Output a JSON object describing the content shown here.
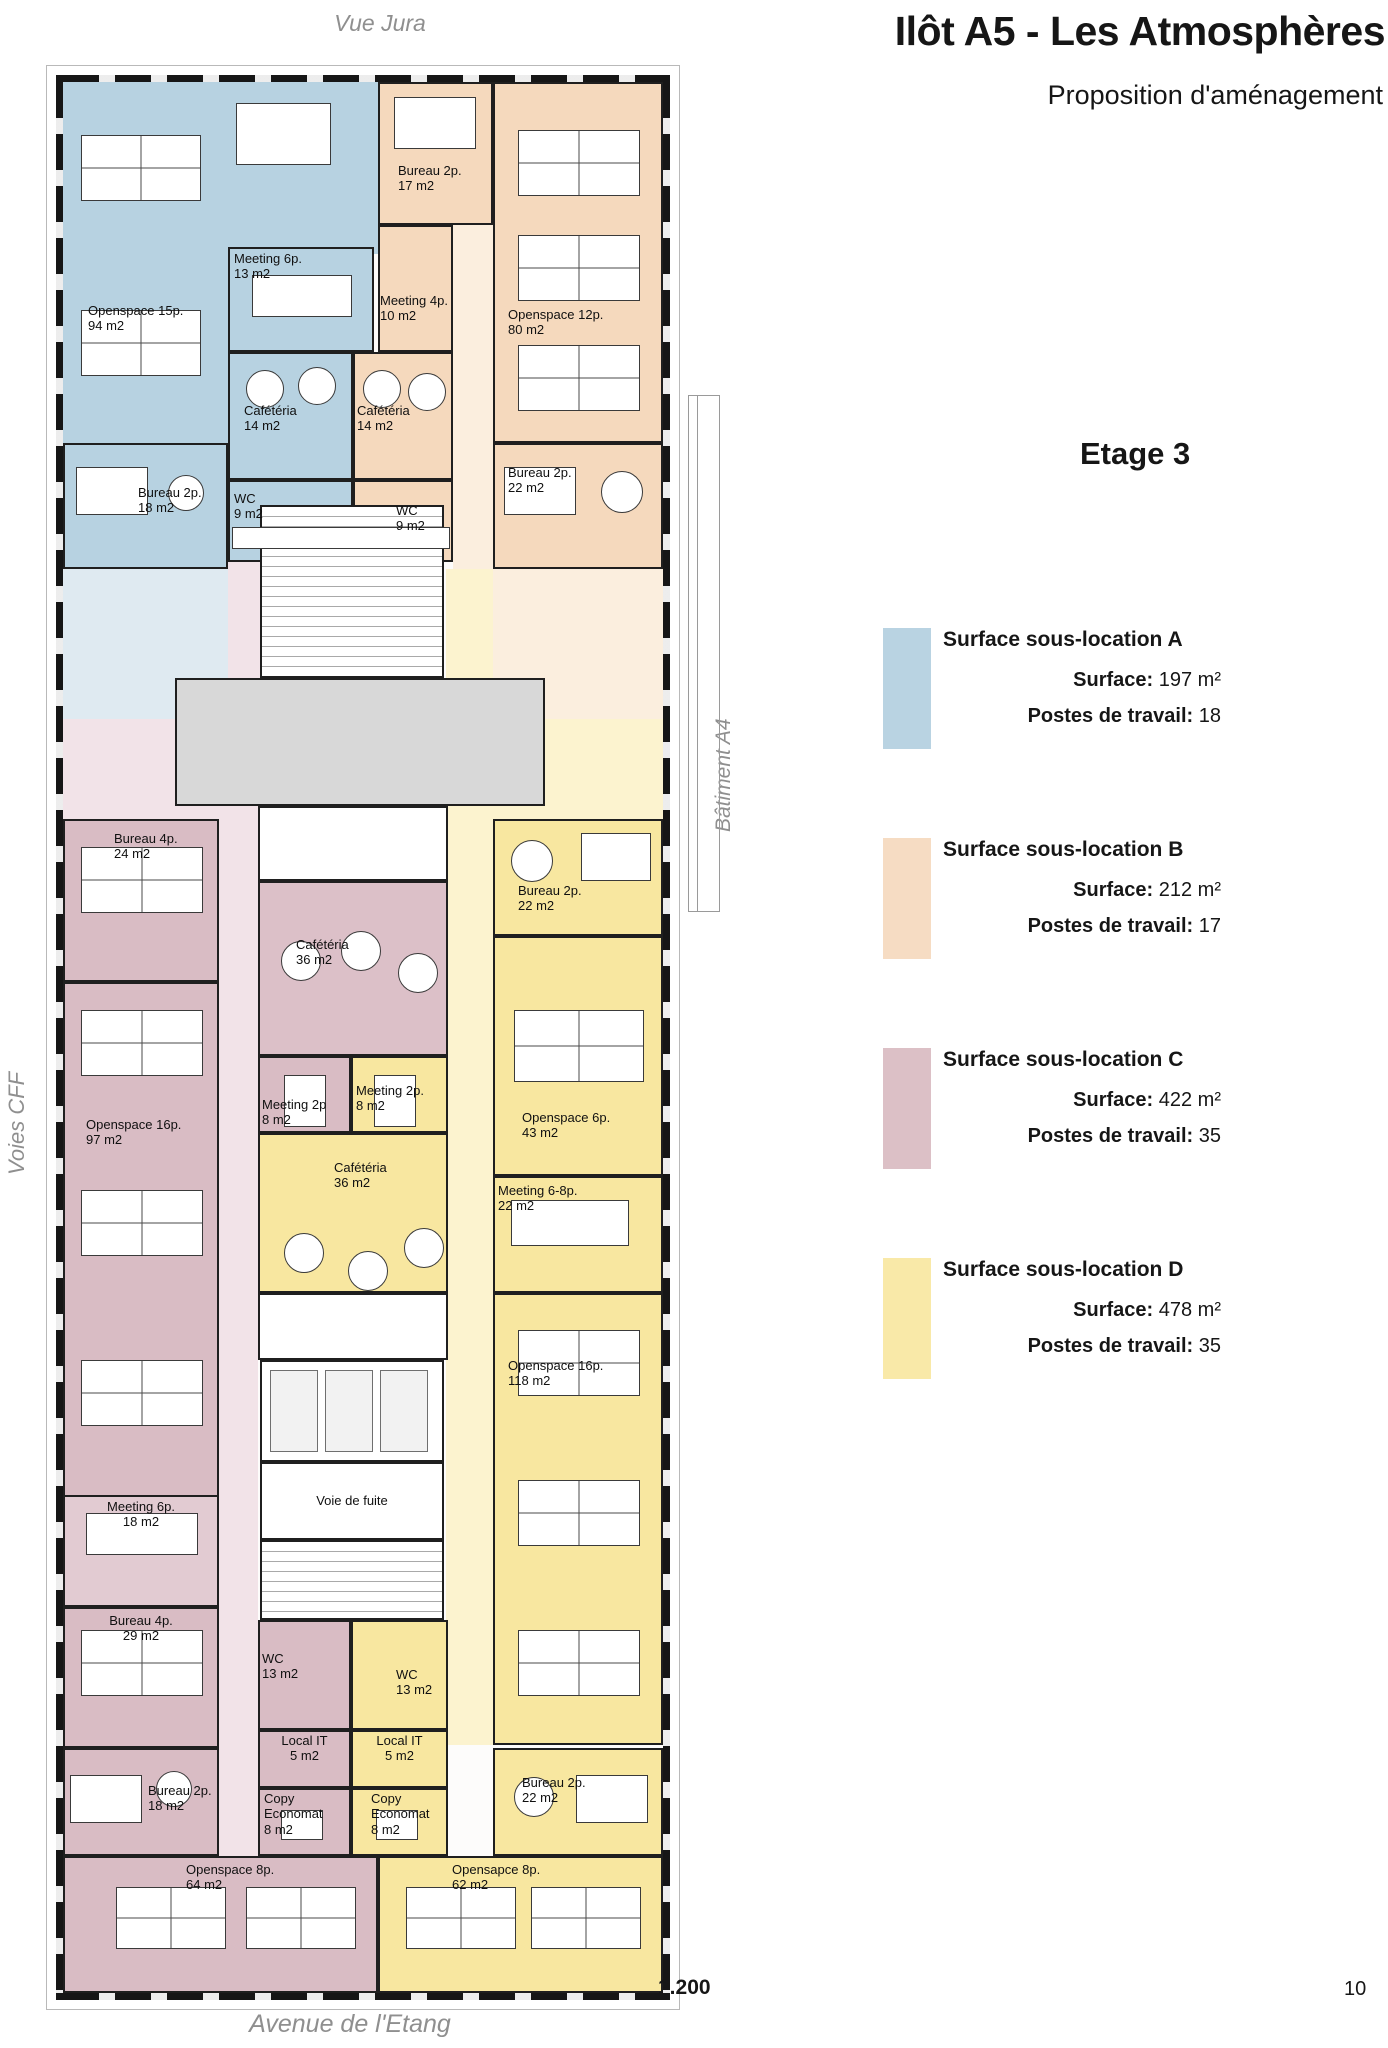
{
  "page": {
    "number": "10",
    "scale_label": "1.200"
  },
  "header": {
    "title": "Ilôt A5 - Les Atmosphères",
    "subtitle": "Proposition d'aménagement",
    "floor_label": "Etage 3"
  },
  "surroundings": {
    "top": "Vue Jura",
    "left": "Voies CFF",
    "right": "Bâtiment A4",
    "bottom": "Avenue de l'Etang"
  },
  "legend": {
    "items": [
      {
        "id": "A",
        "color": "#b9d3e2",
        "title": "Surface sous-location A",
        "surface_label": "Surface:",
        "surface_value": "197 m²",
        "postes_label": "Postes de travail:",
        "postes_value": "18"
      },
      {
        "id": "B",
        "color": "#f6dcc3",
        "title": "Surface sous-location B",
        "surface_label": "Surface:",
        "surface_value": "212 m²",
        "postes_label": "Postes de travail:",
        "postes_value": "17"
      },
      {
        "id": "C",
        "color": "#dcc0c6",
        "title": "Surface sous-location C",
        "surface_label": "Surface:",
        "surface_value": "422 m²",
        "postes_label": "Postes de travail:",
        "postes_value": "35"
      },
      {
        "id": "D",
        "color": "#f9e9a8",
        "title": "Surface sous-location D",
        "surface_label": "Surface:",
        "surface_value": "478 m²",
        "postes_label": "Postes de travail:",
        "postes_value": "35"
      }
    ]
  },
  "floorplan": {
    "zone_colors": {
      "A": "#b7d2e1",
      "B": "#f5d9bd",
      "C": "#d9bcc4",
      "D": "#f8e7a0",
      "core": "#d8d8d8"
    },
    "rooms": [
      {
        "id": "zone-a-band",
        "x": 7,
        "y": 7,
        "w": 315,
        "h": 172,
        "fill": "#b7d2e1",
        "wall": false
      },
      {
        "id": "openspace-15p",
        "x": 7,
        "y": 179,
        "w": 165,
        "h": 189,
        "fill": "#b7d2e1",
        "wall": false,
        "label": "Openspace 15p.\n94 m2",
        "lx": 32,
        "ly": 228
      },
      {
        "id": "corridor-b",
        "x": 397,
        "y": 7,
        "w": 40,
        "h": 487,
        "fill": "#fbeede",
        "wall": false
      },
      {
        "id": "lounge-a",
        "x": 7,
        "y": 494,
        "w": 165,
        "h": 150,
        "fill": "#dfeaf1",
        "wall": false
      },
      {
        "id": "lounge-c-left",
        "x": 7,
        "y": 644,
        "w": 165,
        "h": 100,
        "fill": "#f2e3e8",
        "wall": false
      },
      {
        "id": "lounge-b",
        "x": 437,
        "y": 494,
        "w": 170,
        "h": 150,
        "fill": "#fbeede",
        "wall": false
      },
      {
        "id": "lounge-d",
        "x": 437,
        "y": 644,
        "w": 170,
        "h": 100,
        "fill": "#fcf3cf",
        "wall": false
      },
      {
        "id": "corridor-c-upper",
        "x": 172,
        "y": 487,
        "w": 32,
        "h": 319,
        "fill": "#f2e3e8",
        "wall": false
      },
      {
        "id": "corridor-c-lower",
        "x": 163,
        "y": 744,
        "w": 39,
        "h": 1037,
        "fill": "#f2e3e8",
        "wall": false
      },
      {
        "id": "corridor-d",
        "x": 390,
        "y": 494,
        "w": 47,
        "h": 1176,
        "fill": "#fcf3cf",
        "wall": false
      },
      {
        "id": "meeting-6p-13",
        "x": 172,
        "y": 172,
        "w": 146,
        "h": 105,
        "fill": "#b7d2e1",
        "label": "Meeting 6p.\n13 m2",
        "lx": 178,
        "ly": 176
      },
      {
        "id": "cafeteria-14-a",
        "x": 172,
        "y": 277,
        "w": 125,
        "h": 128,
        "fill": "#b7d2e1",
        "label": "Cafétéria\n14 m2",
        "lx": 188,
        "ly": 328
      },
      {
        "id": "wc-9-a",
        "x": 172,
        "y": 405,
        "w": 125,
        "h": 82,
        "fill": "#b7d2e1",
        "label": "WC\n9 m2",
        "lx": 178,
        "ly": 416
      },
      {
        "id": "bureau-2p-18-a",
        "x": 7,
        "y": 368,
        "w": 165,
        "h": 126,
        "fill": "#b7d2e1",
        "label": "Bureau 2p.\n18 m2",
        "lx": 82,
        "ly": 410
      },
      {
        "id": "bureau-2p-17",
        "x": 322,
        "y": 7,
        "w": 115,
        "h": 143,
        "fill": "#f5d9bd",
        "label": "Bureau 2p.\n17 m2",
        "lx": 342,
        "ly": 88
      },
      {
        "id": "meeting-4p-10",
        "x": 322,
        "y": 150,
        "w": 75,
        "h": 127,
        "fill": "#f5d9bd",
        "label": "Meeting 4p.\n10 m2",
        "lx": 324,
        "ly": 218
      },
      {
        "id": "cafeteria-14-b",
        "x": 297,
        "y": 277,
        "w": 100,
        "h": 128,
        "fill": "#f5d9bd",
        "label": "Cafétéria\n14 m2",
        "lx": 301,
        "ly": 328
      },
      {
        "id": "wc-9-b",
        "x": 297,
        "y": 405,
        "w": 100,
        "h": 82,
        "fill": "#f5d9bd",
        "label": "WC\n9 m2",
        "lx": 340,
        "ly": 428
      },
      {
        "id": "openspace-12p",
        "x": 437,
        "y": 7,
        "w": 170,
        "h": 361,
        "fill": "#f5d9bd",
        "label": "Openspace 12p.\n80 m2",
        "lx": 452,
        "ly": 232
      },
      {
        "id": "bureau-2p-22-b",
        "x": 437,
        "y": 368,
        "w": 170,
        "h": 126,
        "fill": "#f5d9bd",
        "label": "Bureau 2p.\n22 m2",
        "lx": 452,
        "ly": 390
      },
      {
        "id": "stairs-top",
        "x": 204,
        "y": 430,
        "w": 184,
        "h": 173,
        "fill": "#ffffff",
        "hatch": true
      },
      {
        "id": "entry-hall",
        "x": 119,
        "y": 603,
        "w": 370,
        "h": 128,
        "fill": "#d8d8d8"
      },
      {
        "id": "core-landing",
        "x": 202,
        "y": 731,
        "w": 190,
        "h": 75,
        "fill": "#ffffff"
      },
      {
        "id": "bureau-4p-24",
        "x": 7,
        "y": 744,
        "w": 156,
        "h": 163,
        "fill": "#d9bcc4",
        "label": "Bureau 4p.\n24 m2",
        "lx": 58,
        "ly": 756
      },
      {
        "id": "cafeteria-36-c",
        "x": 202,
        "y": 806,
        "w": 190,
        "h": 175,
        "fill": "#dcc0c8",
        "label": "Cafétéria\n36 m2",
        "lx": 240,
        "ly": 862
      },
      {
        "id": "openspace-16p-97",
        "x": 7,
        "y": 907,
        "w": 156,
        "h": 518,
        "fill": "#d9bcc4",
        "label": "Openspace 16p.\n97 m2",
        "lx": 30,
        "ly": 1042
      },
      {
        "id": "meeting-2p-c",
        "x": 202,
        "y": 981,
        "w": 93,
        "h": 77,
        "fill": "#d9bcc4",
        "label": "Meeting 2p\n8 m2",
        "lx": 206,
        "ly": 1022
      },
      {
        "id": "meeting-2p-d",
        "x": 295,
        "y": 981,
        "w": 97,
        "h": 77,
        "fill": "#f8e7a0",
        "label": "Meeting 2p.\n8 m2",
        "lx": 300,
        "ly": 1008
      },
      {
        "id": "cafeteria-36-d",
        "x": 202,
        "y": 1058,
        "w": 190,
        "h": 160,
        "fill": "#f8e7a0",
        "label": "Cafétéria\n36 m2",
        "lx": 278,
        "ly": 1085
      },
      {
        "id": "bureau-2p-22-d-top",
        "x": 437,
        "y": 744,
        "w": 170,
        "h": 117,
        "fill": "#f8e7a0",
        "label": "Bureau 2p.\n22 m2",
        "lx": 462,
        "ly": 808
      },
      {
        "id": "openspace-6p-43",
        "x": 437,
        "y": 861,
        "w": 170,
        "h": 240,
        "fill": "#f8e7a0",
        "label": "Openspace 6p.\n43 m2",
        "lx": 466,
        "ly": 1035
      },
      {
        "id": "meeting-6-8p-22",
        "x": 437,
        "y": 1101,
        "w": 170,
        "h": 117,
        "fill": "#f8e7a0",
        "label": "Meeting 6-8p.\n22 m2",
        "lx": 442,
        "ly": 1108
      },
      {
        "id": "openspace-16p-118",
        "x": 437,
        "y": 1218,
        "w": 170,
        "h": 452,
        "fill": "#f8e7a0",
        "label": "Openspace 16p.\n118 m2",
        "lx": 452,
        "ly": 1283
      },
      {
        "id": "core-mid",
        "x": 202,
        "y": 1218,
        "w": 190,
        "h": 67,
        "fill": "#ffffff"
      },
      {
        "id": "elevators",
        "x": 204,
        "y": 1285,
        "w": 184,
        "h": 102,
        "fill": "#ffffff"
      },
      {
        "id": "voie-de-fuite",
        "x": 204,
        "y": 1387,
        "w": 184,
        "h": 78,
        "fill": "#ffffff",
        "label": "Voie de fuite",
        "la": "c",
        "ly": 1418
      },
      {
        "id": "stairs-bottom",
        "x": 204,
        "y": 1465,
        "w": 184,
        "h": 80,
        "fill": "#ffffff",
        "hatch": true
      },
      {
        "id": "wc-13-c",
        "x": 202,
        "y": 1545,
        "w": 93,
        "h": 110,
        "fill": "#d9bcc4",
        "label": "WC\n13 m2",
        "lx": 206,
        "ly": 1576
      },
      {
        "id": "wc-13-d",
        "x": 295,
        "y": 1545,
        "w": 97,
        "h": 110,
        "fill": "#f8e7a0",
        "label": "WC\n13 m2",
        "lx": 340,
        "ly": 1592
      },
      {
        "id": "local-it-c",
        "x": 202,
        "y": 1655,
        "w": 93,
        "h": 58,
        "fill": "#d9bcc4",
        "label": "Local IT\n5 m2",
        "la": "c",
        "ly": 1658
      },
      {
        "id": "local-it-d",
        "x": 295,
        "y": 1655,
        "w": 97,
        "h": 58,
        "fill": "#f8e7a0",
        "label": "Local IT\n5 m2",
        "la": "c",
        "ly": 1658
      },
      {
        "id": "copy-economat-c",
        "x": 202,
        "y": 1713,
        "w": 93,
        "h": 68,
        "fill": "#d9bcc4",
        "label": "Copy\nEconomat\n8 m2",
        "lx": 208,
        "ly": 1716
      },
      {
        "id": "copy-economat-d",
        "x": 295,
        "y": 1713,
        "w": 97,
        "h": 68,
        "fill": "#f8e7a0",
        "label": "Copy\nEconomat\n8 m2",
        "lx": 315,
        "ly": 1716
      },
      {
        "id": "meeting-6p-18",
        "x": 7,
        "y": 1420,
        "w": 156,
        "h": 112,
        "fill": "#e2cbd2",
        "label": "Meeting 6p.\n18 m2",
        "la": "c",
        "ly": 1424
      },
      {
        "id": "bureau-4p-29",
        "x": 7,
        "y": 1532,
        "w": 156,
        "h": 141,
        "fill": "#d9bcc4",
        "label": "Bureau 4p.\n29 m2",
        "la": "c",
        "ly": 1538
      },
      {
        "id": "bureau-2p-18-c",
        "x": 7,
        "y": 1673,
        "w": 156,
        "h": 108,
        "fill": "#d9bcc4",
        "label": "Bureau 2p.\n18 m2",
        "lx": 92,
        "ly": 1708
      },
      {
        "id": "bureau-2p-22-d",
        "x": 437,
        "y": 1673,
        "w": 170,
        "h": 108,
        "fill": "#f8e7a0",
        "label": "Bureau 2p.\n22 m2",
        "lx": 466,
        "ly": 1700
      },
      {
        "id": "openspace-8p-64",
        "x": 7,
        "y": 1781,
        "w": 315,
        "h": 137,
        "fill": "#d9bcc4",
        "label": "Openspace 8p.\n64 m2",
        "lx": 130,
        "ly": 1787
      },
      {
        "id": "opensapce-8p-62",
        "x": 322,
        "y": 1781,
        "w": 285,
        "h": 137,
        "fill": "#f8e7a0",
        "label": "Opensapce 8p.\n62 m2",
        "lx": 396,
        "ly": 1787
      }
    ],
    "furniture": [
      [
        "c",
        25,
        60,
        120,
        66
      ],
      [
        "c",
        25,
        235,
        120,
        66
      ],
      [
        "r",
        180,
        28,
        95,
        62
      ],
      [
        "r",
        196,
        200,
        100,
        42
      ],
      [
        "o",
        190,
        295,
        38
      ],
      [
        "o",
        242,
        292,
        38
      ],
      [
        "o",
        307,
        295,
        38
      ],
      [
        "o",
        352,
        298,
        38
      ],
      [
        "r",
        338,
        22,
        82,
        52
      ],
      [
        "c",
        462,
        55,
        122,
        66
      ],
      [
        "c",
        462,
        160,
        122,
        66
      ],
      [
        "c",
        462,
        270,
        122,
        66
      ],
      [
        "r",
        448,
        392,
        72,
        48
      ],
      [
        "o",
        545,
        396,
        42
      ],
      [
        "r",
        20,
        392,
        72,
        48
      ],
      [
        "o",
        112,
        400,
        36
      ],
      [
        "r",
        176,
        452,
        218,
        22
      ],
      [
        "c",
        25,
        772,
        122,
        66
      ],
      [
        "o",
        225,
        866,
        40
      ],
      [
        "o",
        285,
        856,
        40
      ],
      [
        "o",
        342,
        878,
        40
      ],
      [
        "c",
        25,
        935,
        122,
        66
      ],
      [
        "c",
        25,
        1115,
        122,
        66
      ],
      [
        "c",
        25,
        1285,
        122,
        66
      ],
      [
        "r",
        228,
        1000,
        42,
        52
      ],
      [
        "r",
        318,
        1000,
        42,
        52
      ],
      [
        "o",
        228,
        1158,
        40
      ],
      [
        "o",
        292,
        1176,
        40
      ],
      [
        "o",
        348,
        1153,
        40
      ],
      [
        "r",
        525,
        758,
        70,
        48
      ],
      [
        "o",
        455,
        765,
        42
      ],
      [
        "c",
        458,
        935,
        130,
        72
      ],
      [
        "r",
        455,
        1125,
        118,
        46
      ],
      [
        "c",
        462,
        1255,
        122,
        66
      ],
      [
        "c",
        462,
        1405,
        122,
        66
      ],
      [
        "c",
        462,
        1555,
        122,
        66
      ],
      [
        "r",
        30,
        1438,
        112,
        42
      ],
      [
        "c",
        25,
        1555,
        122,
        66
      ],
      [
        "r",
        14,
        1700,
        72,
        48
      ],
      [
        "o",
        100,
        1696,
        36
      ],
      [
        "r",
        520,
        1700,
        72,
        48
      ],
      [
        "o",
        458,
        1702,
        40
      ],
      [
        "r",
        225,
        1735,
        42,
        30
      ],
      [
        "r",
        320,
        1735,
        42,
        30
      ],
      [
        "c",
        60,
        1812,
        110,
        62
      ],
      [
        "c",
        190,
        1812,
        110,
        62
      ],
      [
        "c",
        350,
        1812,
        110,
        62
      ],
      [
        "c",
        475,
        1812,
        110,
        62
      ],
      [
        "e",
        214,
        1295,
        48,
        82
      ],
      [
        "e",
        269,
        1295,
        48,
        82
      ],
      [
        "e",
        324,
        1295,
        48,
        82
      ]
    ]
  }
}
